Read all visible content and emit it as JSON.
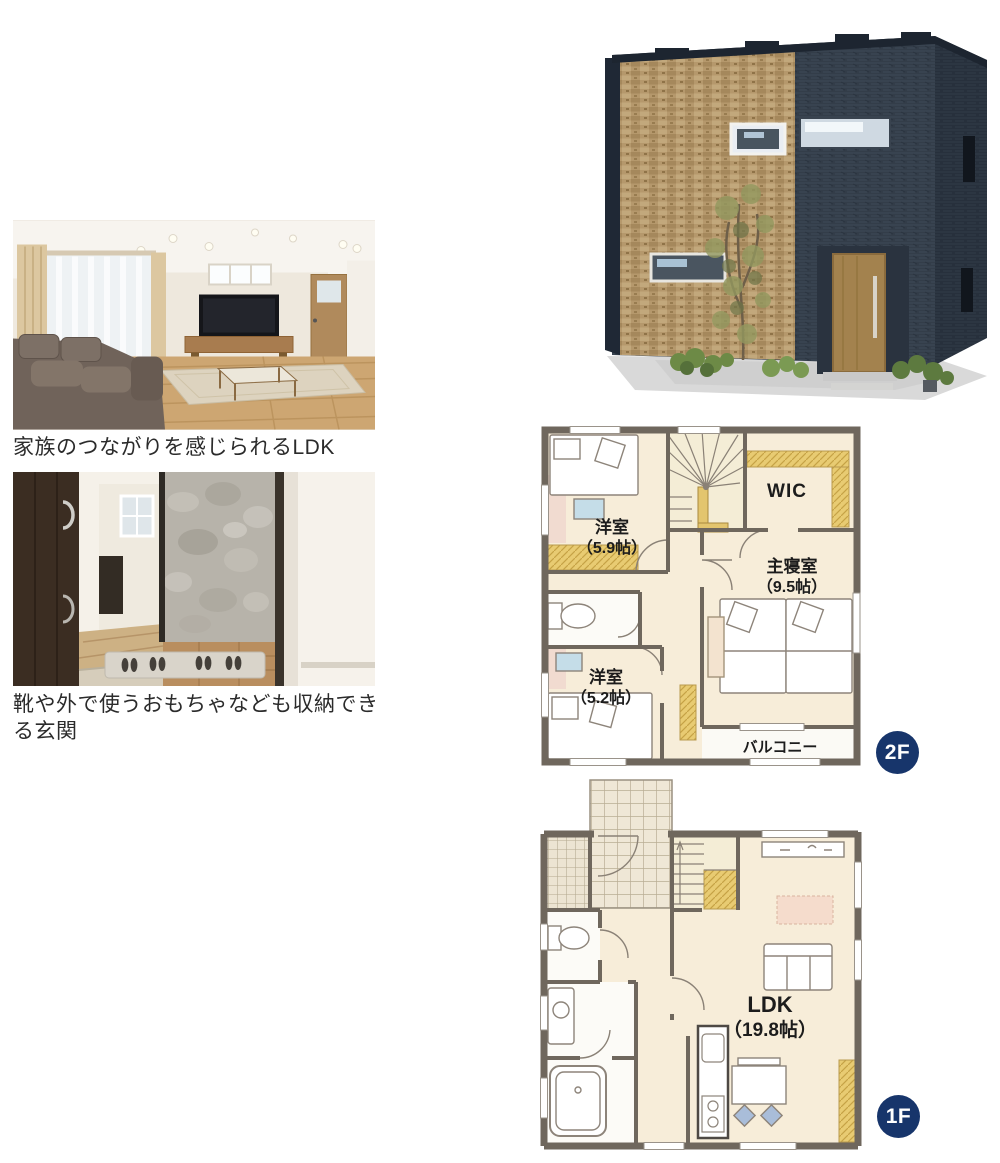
{
  "photos": [
    {
      "caption": "家族のつながりを感じられるLDK"
    },
    {
      "caption": "靴や外で使うおもちゃなども収納できる玄関"
    }
  ],
  "plan_2f": {
    "badge": "2F",
    "rooms": {
      "bedroom1_name": "洋室",
      "bedroom1_size": "（5.9帖）",
      "wic": "WIC",
      "master_name": "主寝室",
      "master_size": "（9.5帖）",
      "bedroom2_name": "洋室",
      "bedroom2_size": "（5.2帖）",
      "balcony": "バルコニー"
    }
  },
  "plan_1f": {
    "badge": "1F",
    "rooms": {
      "ldk_name": "LDK",
      "ldk_size": "（19.8帖）"
    }
  },
  "colors": {
    "badge_navy": "#17356b",
    "plan_floor": "#f7edd9",
    "plan_wall": "#6f675d",
    "closet_yellow": "#e8cb72",
    "caption_text": "#2b2b2b"
  }
}
